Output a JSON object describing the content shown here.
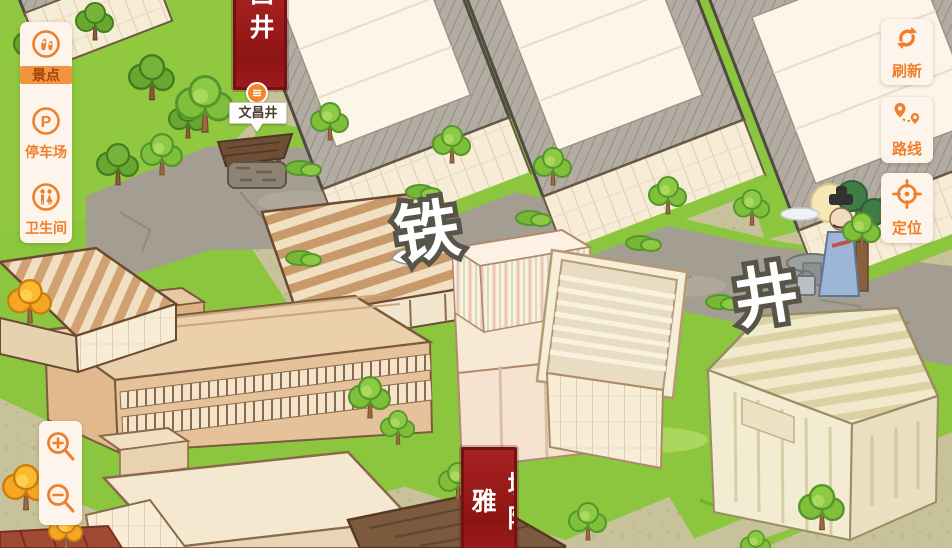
{
  "left_panel": {
    "items": [
      {
        "label": "景点",
        "icon": "scenic-spot-icon",
        "selected": true
      },
      {
        "label": "停车场",
        "icon": "parking-icon",
        "icon_letter": "P",
        "selected": false
      },
      {
        "label": "卫生间",
        "icon": "restroom-icon",
        "selected": false
      }
    ]
  },
  "right_panel": {
    "items": [
      {
        "label": "刷新",
        "icon": "refresh-icon"
      },
      {
        "label": "路线",
        "icon": "route-icon"
      },
      {
        "label": "定位",
        "icon": "locate-icon"
      }
    ]
  },
  "zoom_controls": {
    "zoom_in_icon": "zoom-in-icon",
    "zoom_out_icon": "zoom-out-icon"
  },
  "map": {
    "street_chars": [
      "铁",
      "井"
    ],
    "poi": {
      "label": "文昌井",
      "banner_chars": "昌井"
    },
    "bottom_banner": {
      "chars": "城隍雅"
    }
  },
  "colors": {
    "accent": "#ee7f2d",
    "panel_bg": "#fdf5ec",
    "selected_bg": "#f2943e",
    "selected_text": "#a8430f",
    "banner_red": "#9c1b1e",
    "street_text_fill": "#ffffff",
    "street_text_stroke": "#57544a"
  }
}
